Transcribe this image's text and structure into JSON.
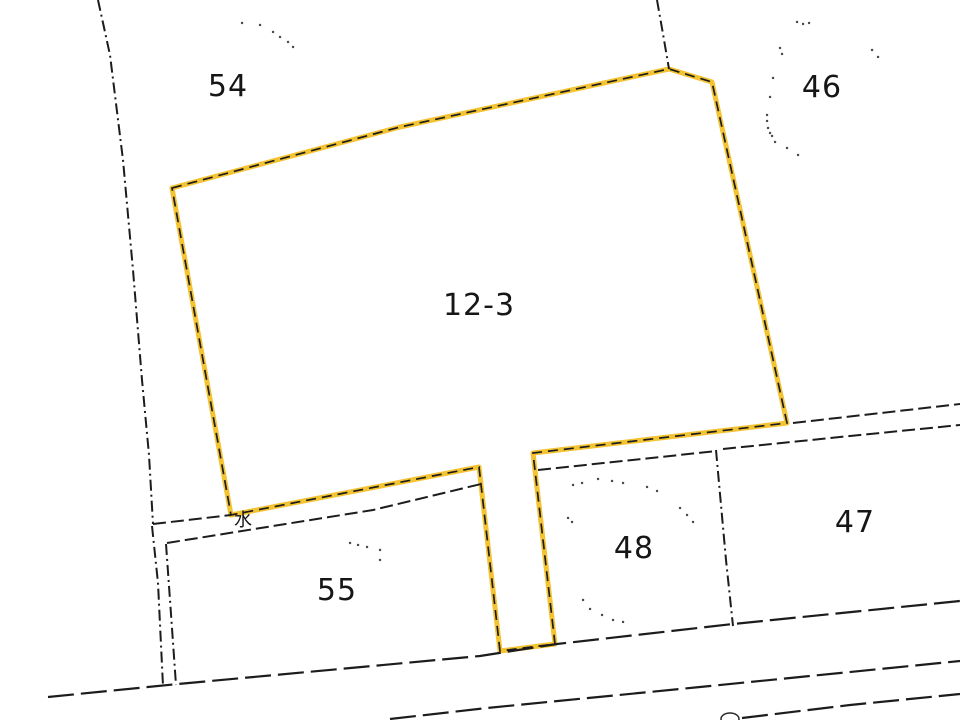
{
  "map": {
    "background_color": "#ffffff",
    "line_color": "#1c1c1c",
    "highlight_color": "#f3c331",
    "highlighted_parcel": "12-3",
    "parcels": [
      {
        "label": "54"
      },
      {
        "label": "46"
      },
      {
        "label": "12-3"
      },
      {
        "label": "47"
      },
      {
        "label": "48"
      },
      {
        "label": "55"
      }
    ],
    "symbols": [
      {
        "label": "水"
      }
    ]
  },
  "geometry": {
    "parcel_12_3_outline": "172,188 400,127 669,69 712,82 787,423 533,453 555,644 500,651 479,467 231,515",
    "boundary_west_curve": "98,0 110,55 123,160 133,270 142,380 149,455 153,524",
    "boundary_54_46": "657,0 663,34 669,69",
    "lane_upper_west": "153,524 231,515",
    "lane_upper_east": "793,423 960,404",
    "parcel_55_top": "167,543 373,510 481,484",
    "parcel_48_top": "538,470 717,451",
    "parcel_47_top": "723,449 850,436 960,425",
    "boundary_48_47": "716,450 726,560 733,626",
    "road_upper_edge": "48,697 178,684 480,656 557,644 733,624 960,601",
    "road_lower_edge": "390,719 487,708 700,687 960,661",
    "road_second_lower_edge": "742,718 850,705 960,694",
    "ditch_line_a": "152,526 158,583 163,686",
    "ditch_line_b": "166,544 170,600 176,685",
    "manhole_path": "M739 719 a9 6 0 1 0 -18 0 a9 6 0 1 0 18 0",
    "dots_parcel_54": "M242 23h.1M260 25h.1M273 32h.1M280 37h.1M288 42h.1M293 47h.1",
    "dots_parcel_46": "M797 22h.1M803 24h.1M809 23h.1M780 48h.1M782 54h.1M872 50h.1M878 57h.1M773 78h.1M770 97h.1M767 115h.1M767 121h.1M768 128h.1M770 133h.1M772 136h.1M775 142h.1M787 148h.1M798 155h.1",
    "dots_parcel_48": "M573 485h.1M582 483h.1M598 479h.1M612 481h.1M623 483h.1M647 487h.1M657 491h.1M680 508h.1M687 515h.1M693 522h.1M568 518h.1M572 522h.1M583 600h.1M590 609h.1M602 615h.1M613 620h.1M623 622h.1",
    "dots_parcel_55": "M350 543h.1M358 545h.1M367 547h.1M380 550h.1M380 560h.1"
  }
}
